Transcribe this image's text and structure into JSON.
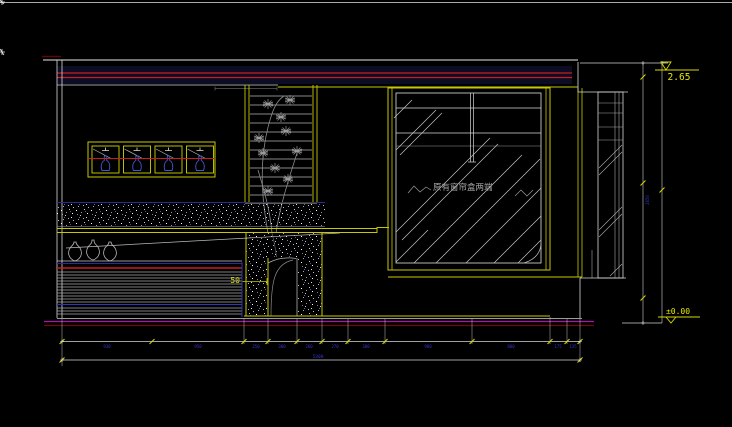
{
  "drawing": {
    "levels": {
      "top": "2.65",
      "floor": "±0.00"
    },
    "annotations": {
      "glass_note": "原有窗帘盒两端",
      "niche_dim": "50"
    },
    "dims": {
      "row1": [
        {
          "value": "930"
        },
        {
          "value": "950"
        },
        {
          "value": "250"
        },
        {
          "value": "300"
        },
        {
          "value": "260"
        },
        {
          "value": "270"
        },
        {
          "value": "380"
        },
        {
          "value": "900"
        },
        {
          "value": "800"
        },
        {
          "value": "175"
        },
        {
          "value": "135"
        }
      ],
      "row2_total": "5300",
      "vertical_total": "2650"
    },
    "colors": {
      "accent_yellow": "#c8c800",
      "line_red": "#c81e1e",
      "dim_blue": "#3434d0",
      "floor_magenta": "#ad13ad",
      "line_white": "#e0e0e0"
    }
  }
}
